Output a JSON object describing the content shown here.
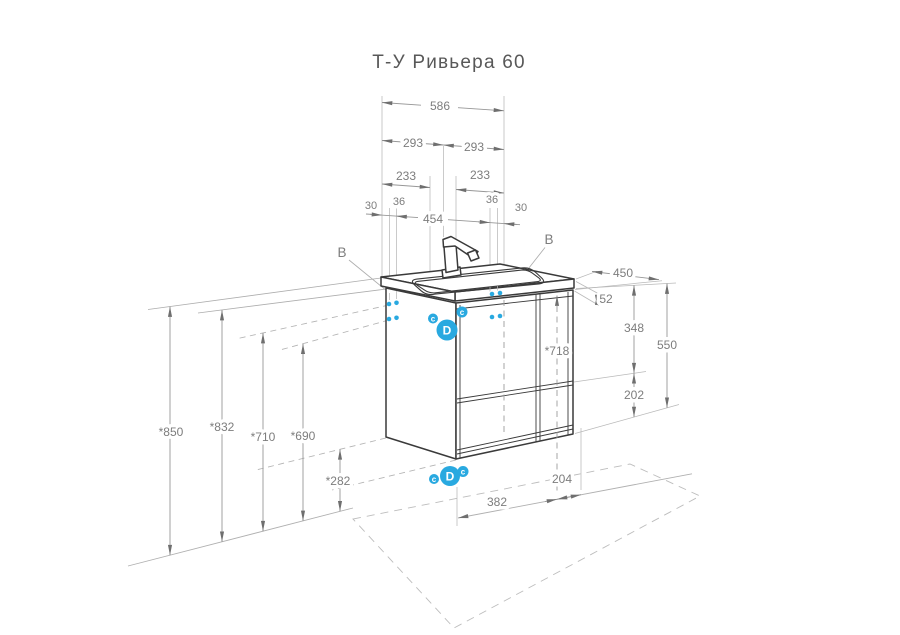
{
  "title": "Т-У Ривьера 60",
  "colors": {
    "accent_blue": "#29a9e0",
    "line_dark": "#3a3a3a",
    "line_dim": "#979797",
    "text_dim": "#7d7d7d"
  },
  "dims": {
    "w586": "586",
    "w293l": "293",
    "w293r": "293",
    "w233l": "233",
    "w233r": "233",
    "w30l": "30",
    "w36l": "36",
    "w454": "454",
    "w36r": "36",
    "w30r": "30",
    "d450": "450",
    "h52": "52",
    "h348": "348",
    "h202": "202",
    "h550": "550",
    "h718": "*718",
    "h850": "*850",
    "h832": "*832",
    "h710": "*710",
    "h690": "*690",
    "h282": "*282",
    "b382": "382",
    "b204": "204"
  },
  "callouts": {
    "b_left": "B",
    "b_right": "B",
    "d_upper": "D",
    "d_lower": "D",
    "c_upper_left": "c",
    "c_upper_right": "c",
    "c_lower_left": "c",
    "c_lower_right": "c"
  }
}
